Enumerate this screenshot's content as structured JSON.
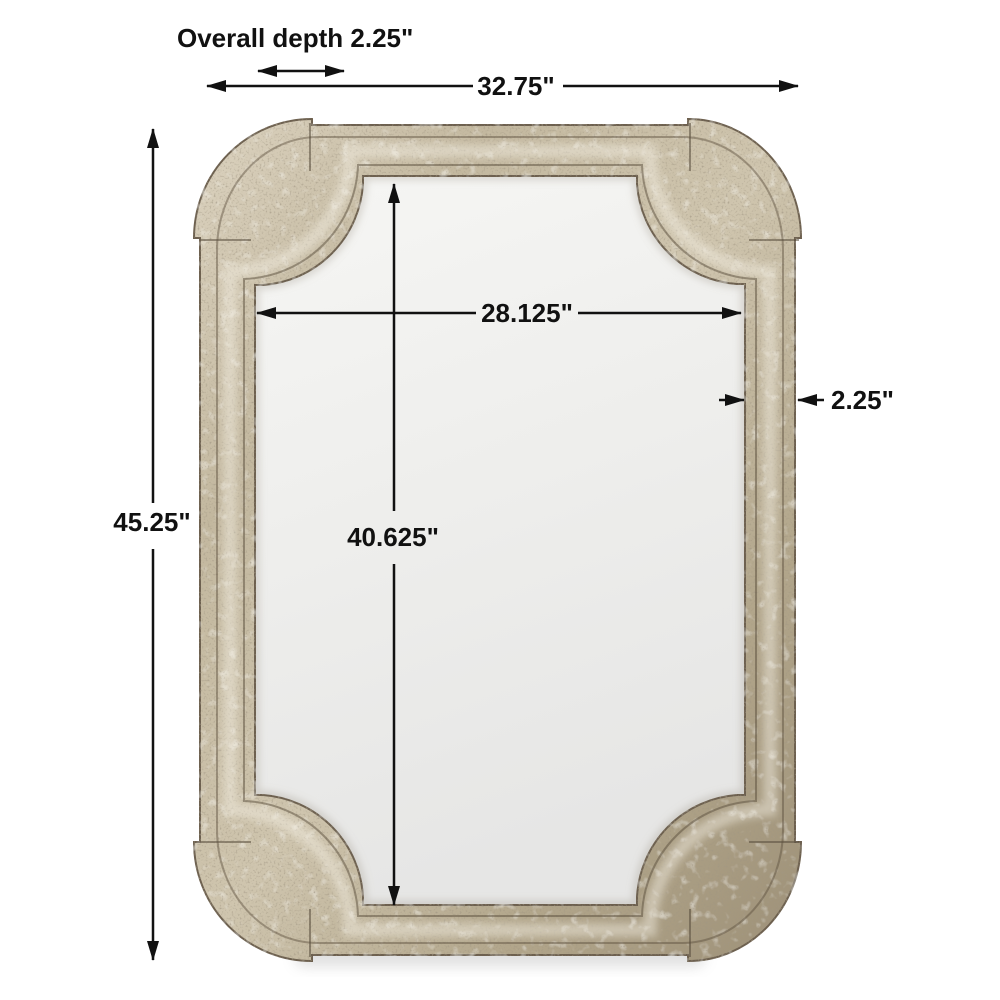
{
  "diagram": {
    "type": "product-dimension-diagram",
    "subject": "Antiqued champagne-silver wall mirror with stepped scalloped corners",
    "background_color": "#ffffff",
    "dimension_line_color": "#111111",
    "frame_colors": {
      "base": "#c7bca4",
      "highlight": "#e6dfcd",
      "shadow": "#8d8069",
      "crevice": "#5f5443"
    },
    "glass_colors": {
      "top": "#f6f6f4",
      "bottom": "#e6e6e5"
    }
  },
  "dimensions": {
    "overall_depth": {
      "label": "Overall depth 2.25\"",
      "orientation": "horizontal",
      "measures": "front-to-back depth"
    },
    "overall_width": {
      "label": "32.75\"",
      "orientation": "horizontal",
      "measures": "overall frame width"
    },
    "overall_height": {
      "label": "45.25\"",
      "orientation": "vertical",
      "measures": "overall frame height"
    },
    "inner_width": {
      "label": "28.125\"",
      "orientation": "horizontal",
      "measures": "mirror glass width"
    },
    "inner_height": {
      "label": "40.625\"",
      "orientation": "vertical",
      "measures": "mirror glass height"
    },
    "frame_thickness": {
      "label": "2.25\"",
      "orientation": "horizontal",
      "measures": "frame rail thickness"
    }
  }
}
